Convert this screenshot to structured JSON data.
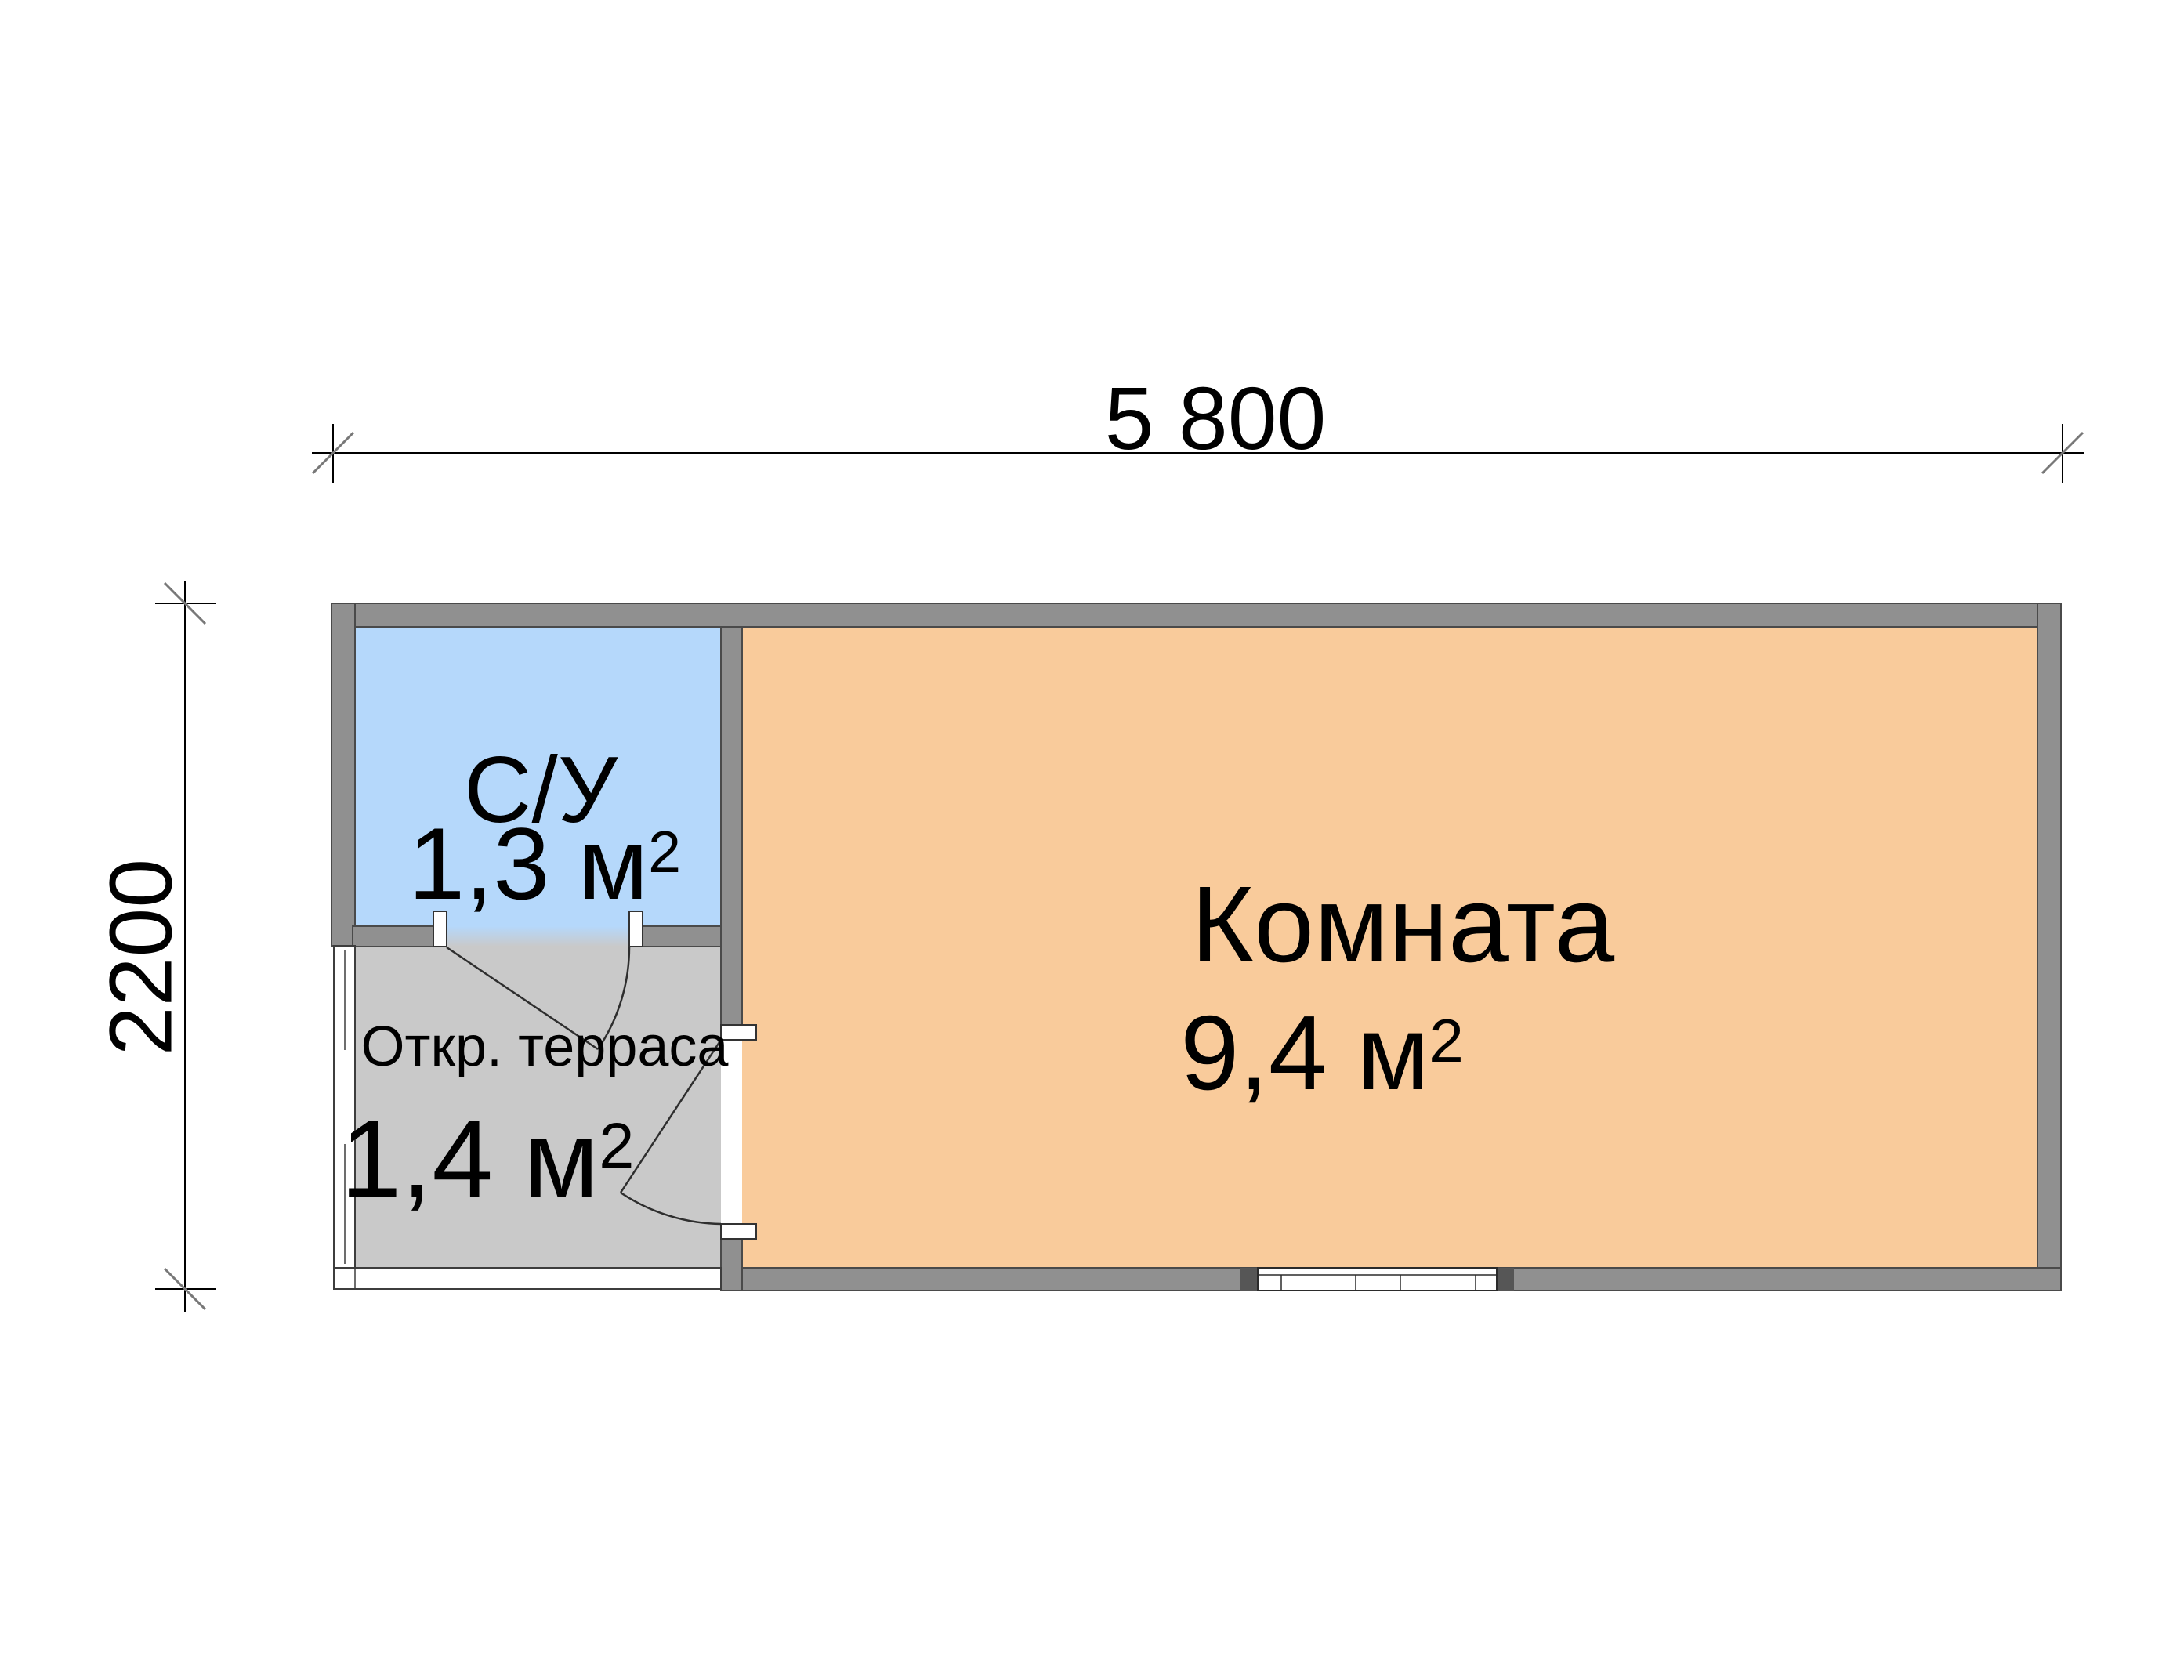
{
  "dimensions": {
    "width_label": "5 800",
    "height_label": "2200"
  },
  "rooms": {
    "bathroom": {
      "name": "С/У",
      "area_value": "1,3 м",
      "area_sup": "2",
      "fill": "#b5d8fb"
    },
    "terrace": {
      "name": "Откр. терраса",
      "area_value": "1,4 м",
      "area_sup": "2",
      "fill": "#c9c9c9"
    },
    "main_room": {
      "name": "Комната",
      "area_value": "9,4 м",
      "area_sup": "2",
      "fill": "#f9cb9b"
    }
  },
  "colors": {
    "wall_fill": "#909090",
    "wall_outline": "#4a4a4a",
    "open_edge_fill": "#ffffff",
    "window_end_fill": "#565656",
    "dimension_line": "#000000",
    "dimension_tick": "#787878",
    "text": "#000000",
    "background": "#ffffff"
  }
}
